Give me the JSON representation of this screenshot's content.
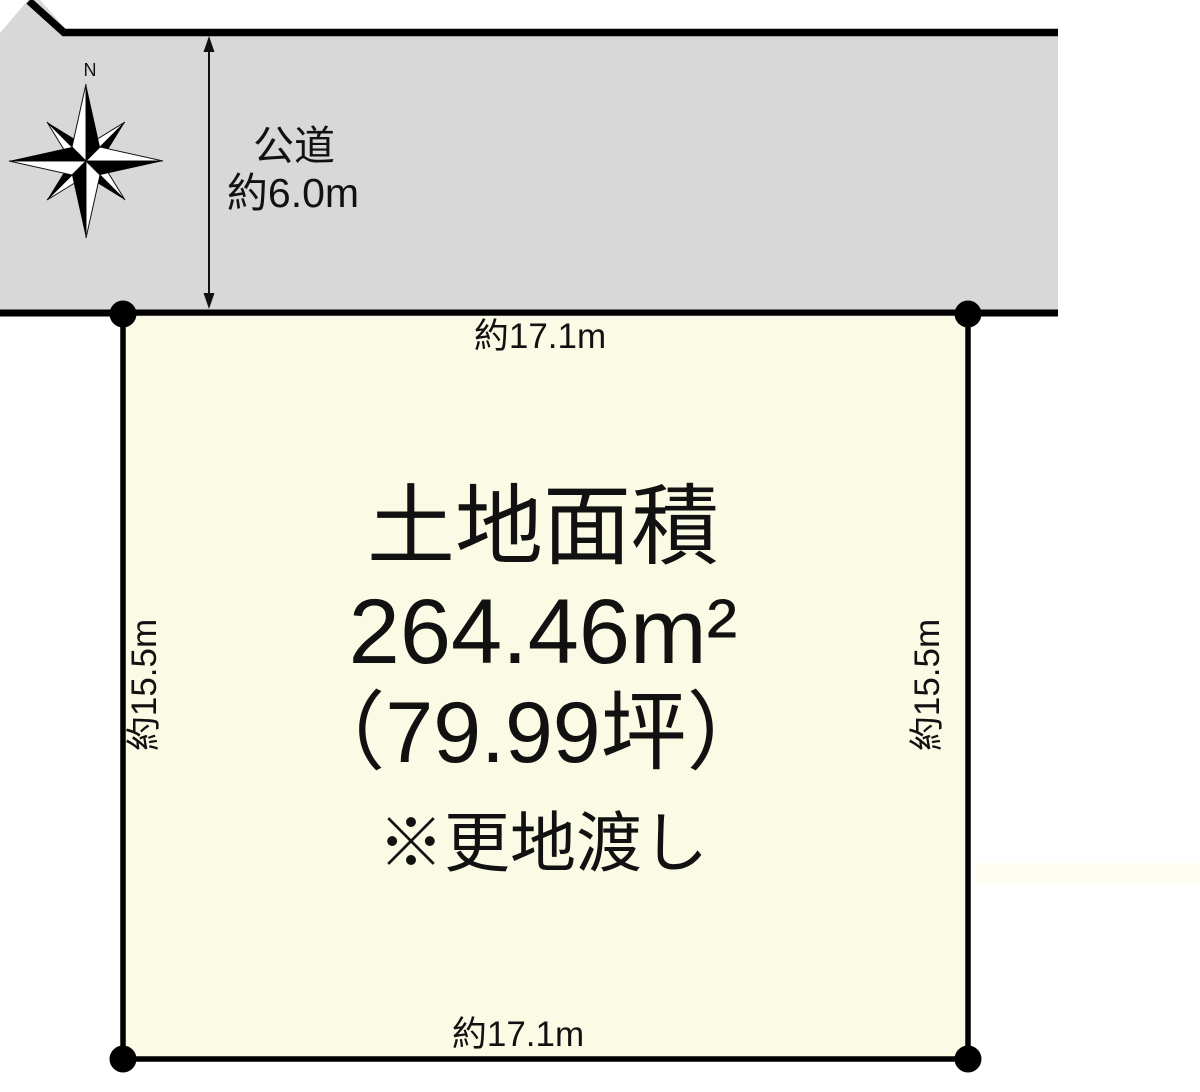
{
  "compass": {
    "north": "N"
  },
  "road": {
    "label_line1": "公道",
    "label_line2": "約6.0m"
  },
  "plot": {
    "title": "土地面積",
    "area_m2": "264.46m²",
    "area_tsubo": "（79.99坪）",
    "note": "※更地渡し"
  },
  "dimensions": {
    "top": "約17.1m",
    "bottom": "約17.1m",
    "left": "約15.5m",
    "right": "約15.5m"
  },
  "colors": {
    "road_fill": "#d8d8d8",
    "plot_fill": "#fbfbe5",
    "line": "#000000",
    "text": "#111111"
  }
}
